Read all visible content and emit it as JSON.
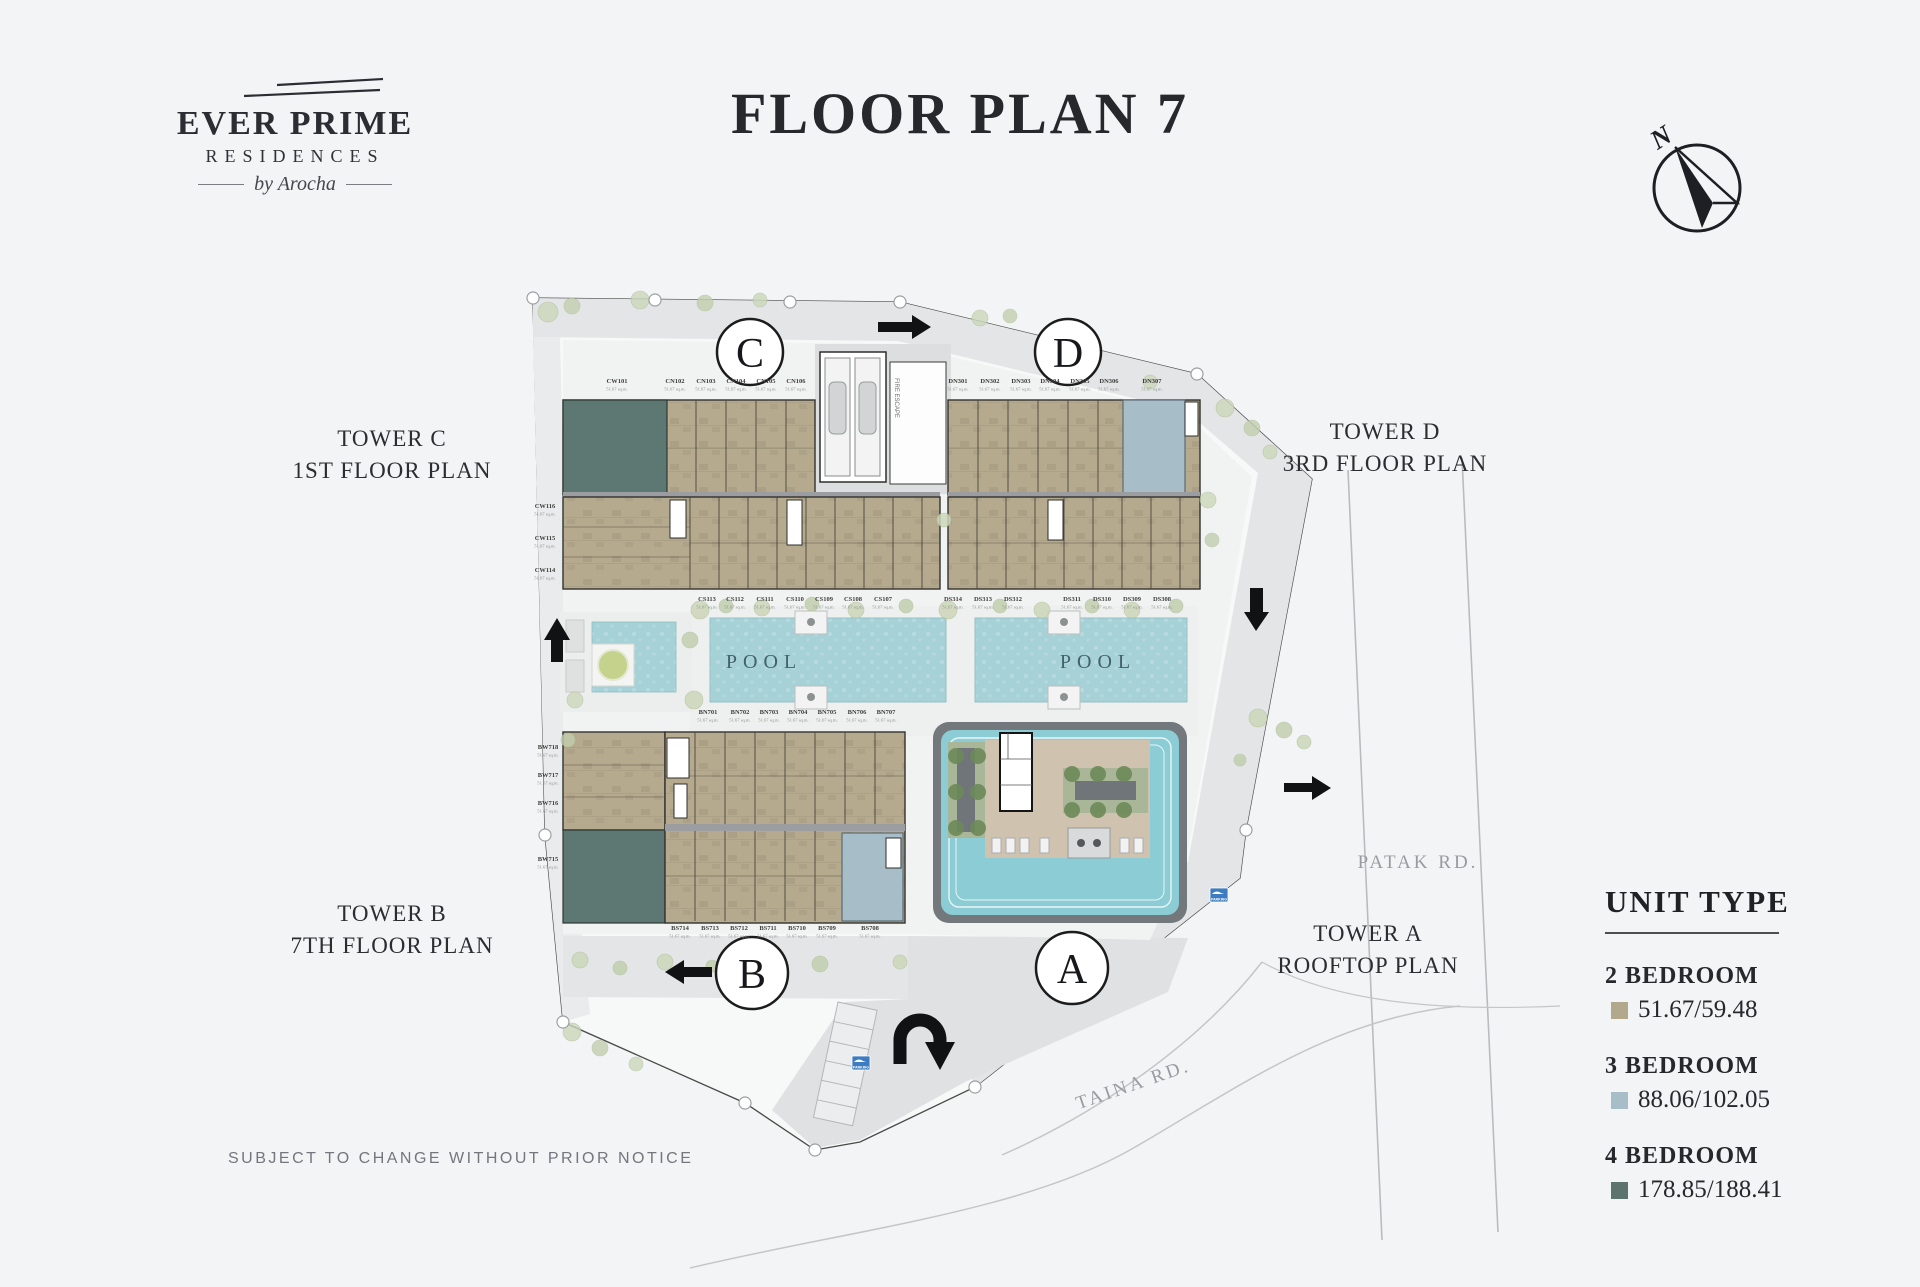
{
  "page": {
    "background": "#f3f4f6"
  },
  "logo": {
    "title": "EVER PRIME",
    "subtitle": "RESIDENCES",
    "byline": "by Arocha"
  },
  "header": {
    "title": "FLOOR PLAN 7"
  },
  "compass": {
    "label": "N"
  },
  "tower_labels": [
    {
      "line1": "TOWER C",
      "line2": "1ST FLOOR PLAN"
    },
    {
      "line1": "TOWER D",
      "line2": "3RD FLOOR PLAN"
    },
    {
      "line1": "TOWER B",
      "line2": "7TH FLOOR PLAN"
    },
    {
      "line1": "TOWER A",
      "line2": "ROOFTOP PLAN"
    }
  ],
  "plan": {
    "markers": [
      "C",
      "D",
      "B",
      "A"
    ],
    "pool_label": "POOL",
    "roads": {
      "patak": "PATAK RD.",
      "taina": "TAINA RD."
    },
    "fire_escape": "FIRE ESCAPE",
    "parking_sign": "PARKING",
    "area_note": "51.67 sq.m.",
    "unit_rows": {
      "c_top": [
        "CW101",
        "CN102",
        "CN103",
        "CN104",
        "CN105",
        "CN106"
      ],
      "c_left": [
        "CW116",
        "CW115",
        "CW114"
      ],
      "c_bottom": [
        "CS113",
        "CS112",
        "CS111",
        "CS110",
        "CS109",
        "CS108",
        "CS107"
      ],
      "d_top": [
        "DN301",
        "DN302",
        "DN303",
        "DN304",
        "DN305",
        "DN306",
        "DN307"
      ],
      "d_bottom": [
        "DS314",
        "DS313",
        "DS312",
        "DS311",
        "DS310",
        "DS309",
        "DS308"
      ],
      "b_left": [
        "BW718",
        "BW717",
        "BW716",
        "BW715"
      ],
      "b_mid": [
        "BN701",
        "BN702",
        "BN703",
        "BN704",
        "BN705",
        "BN706",
        "BN707"
      ],
      "b_bottom": [
        "BS714",
        "BS713",
        "BS712",
        "BS711",
        "BS710",
        "BS709",
        "BS708"
      ]
    }
  },
  "legend": {
    "title": "UNIT TYPE",
    "items": [
      {
        "label": "2 BEDROOM",
        "value": "51.67/59.48",
        "color": "#b2a88b"
      },
      {
        "label": "3 BEDROOM",
        "value": "88.06/102.05",
        "color": "#a7bdc8"
      },
      {
        "label": "4 BEDROOM",
        "value": "178.85/188.41",
        "color": "#5c736e"
      }
    ]
  },
  "footer": {
    "disclaimer": "SUBJECT TO CHANGE WITHOUT PRIOR NOTICE"
  }
}
